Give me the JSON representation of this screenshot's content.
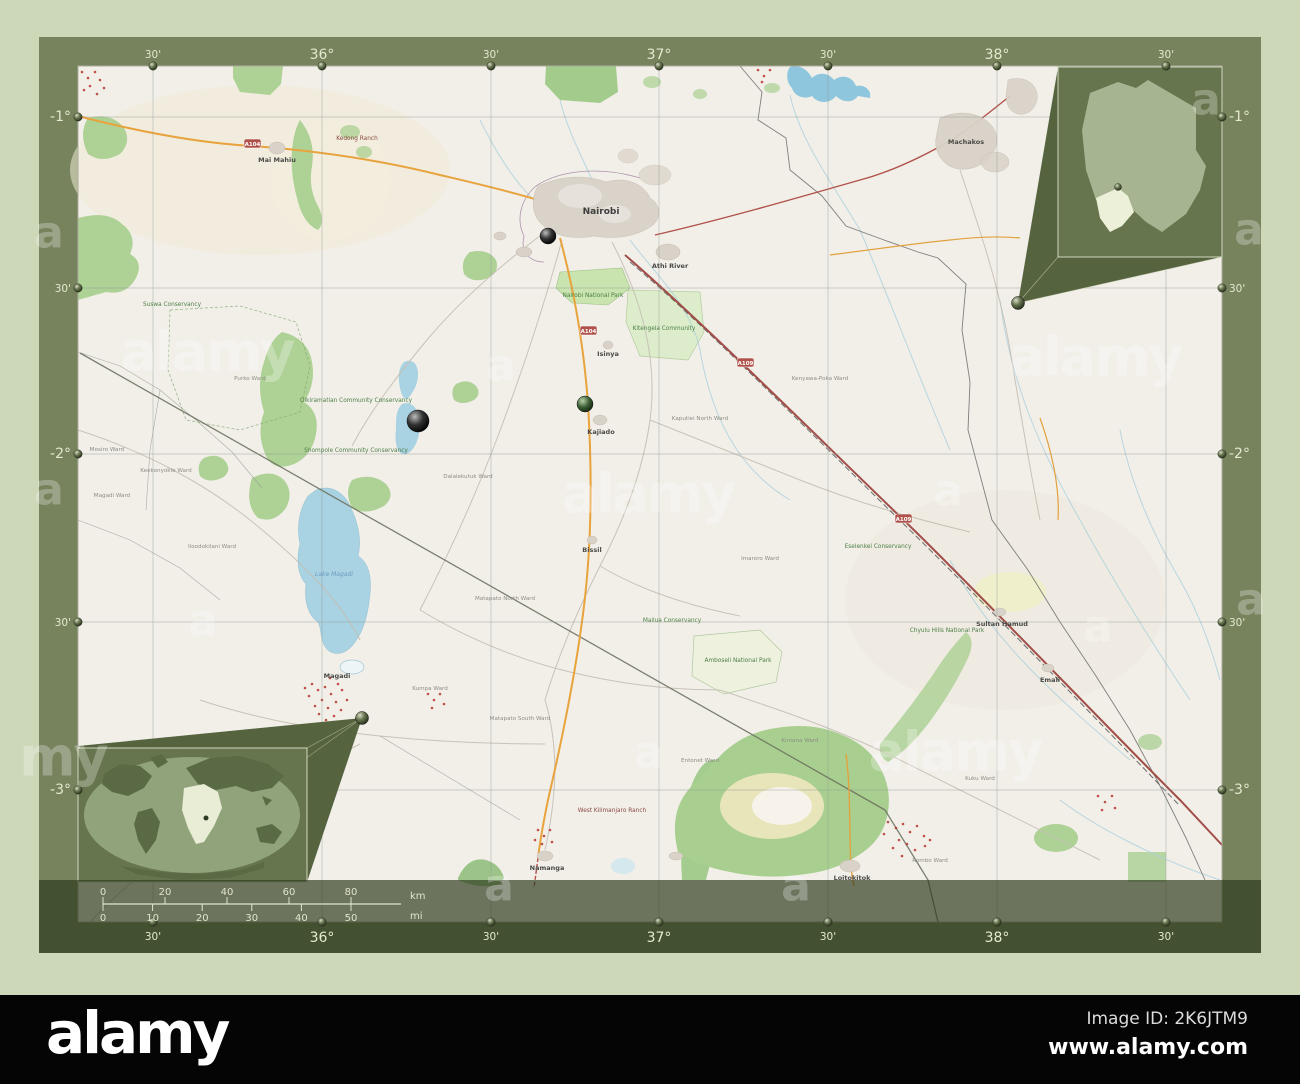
{
  "alamy_bar": {
    "logo": "alamy",
    "image_id": "Image ID: 2K6JTM9",
    "url": "www.alamy.com"
  },
  "watermark": {
    "word": "alamy",
    "letter": "a",
    "partial": "my"
  },
  "coords": {
    "lon": [
      "30'",
      "36°",
      "30'",
      "37°",
      "30'",
      "38°",
      "30'"
    ],
    "lat": [
      "-1°",
      "30'",
      "-2°",
      "30'",
      "-3°"
    ]
  },
  "scalebar": {
    "km": [
      "0",
      "20",
      "40",
      "60",
      "80"
    ],
    "km_unit": "km",
    "mi": [
      "0",
      "10",
      "20",
      "30",
      "40",
      "50"
    ],
    "mi_unit": "mi"
  },
  "road_shields": {
    "a104": "A104",
    "a109": "A109"
  },
  "map_labels": {
    "nairobi": "Nairobi",
    "machakos": "Machakos",
    "athi_river": "Athi River",
    "kajiado": "Kajiado",
    "isinya": "Isinya",
    "bissil": "Bissil",
    "namanga": "Namanga",
    "magadi": "Magadi",
    "loitokitok": "Loitokitok",
    "mai_mahiu": "Mai Mahiu",
    "sultan_hamud": "Sultan Hamud",
    "emali": "Emali",
    "nnp": "Nairobi National Park",
    "suswa": "Suswa Conservancy",
    "olkiramatian": "Olkiramatian Community Conservancy",
    "shompole": "Shompole Community Conservancy",
    "kitengela": "Kitengela Community",
    "mailua": "Mailua Conservancy",
    "eselenkei": "Eselenkei Conservancy",
    "amboseli": "Amboseli National Park",
    "chyulu": "Chyulu Hills National Park",
    "west_kili": "West Kilimanjaro Ranch",
    "kedong": "Kedong Ranch",
    "lake_magadi": "Lake Magadi"
  },
  "wards": [
    "Mosiro Ward",
    "Magadi Ward",
    "Keekonyokie Ward",
    "Iloodokilani Ward",
    "Dalalekutuk Ward",
    "Matapato North Ward",
    "Matapato South Ward",
    "Kaputiei North Ward",
    "Imaroro Ward",
    "Kenyawa-Poka Ward",
    "Kumpa Ward",
    "Entonet Ward",
    "Kimana Ward",
    "Rombo Ward",
    "Kuku Ward",
    "Purko Ward"
  ],
  "colors": {
    "background": "#cdd8b8",
    "frame": "#76835d",
    "map_bg": "#f2efe9",
    "water": "#a9d2e2",
    "forest": "#aed196",
    "urban": "#d9d2c8",
    "trunk_road": "#e8a33d",
    "primary_road": "#b0524a",
    "inset_bg": "#66754d",
    "wedge": "#55643f",
    "bottom_bar": "#050505"
  }
}
